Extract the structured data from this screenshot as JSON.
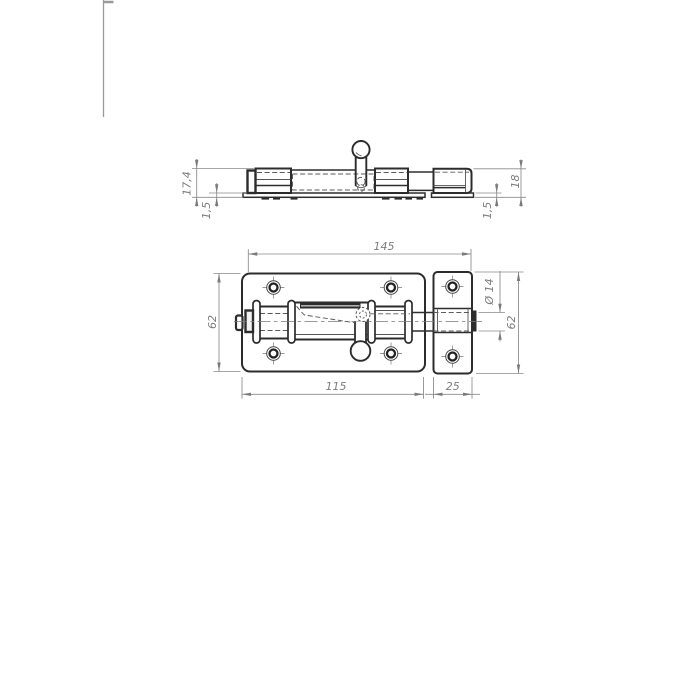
{
  "dimensions": {
    "side_view": {
      "body_height": "17,4",
      "plate_thickness_left": "1,5",
      "keeper_height": "18",
      "plate_thickness_right": "1,5"
    },
    "plan_view": {
      "overall_length": "145",
      "plate_length": "115",
      "keeper_length": "25",
      "plate_height": "62",
      "keeper_height": "62",
      "bolt_diameter": "Ø 14"
    }
  }
}
